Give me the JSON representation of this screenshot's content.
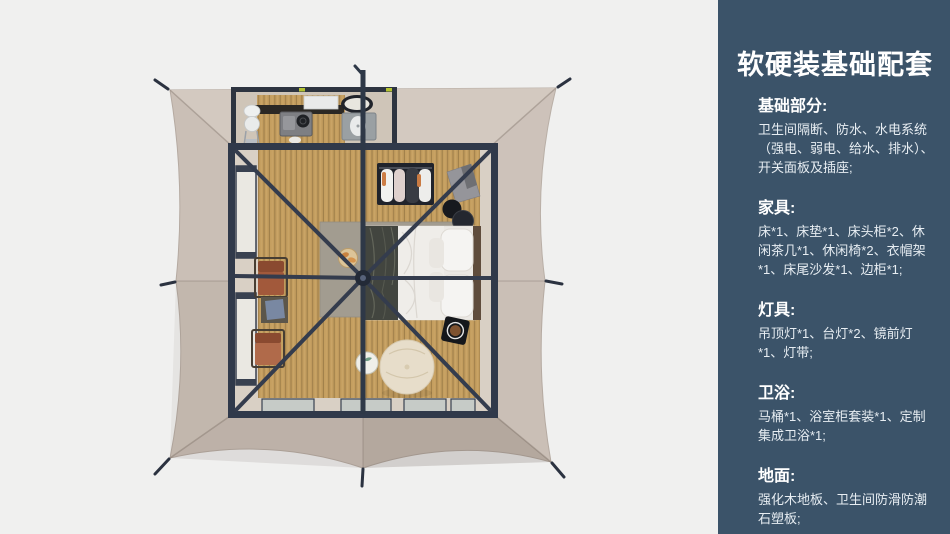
{
  "page": {
    "background": "#f0f0ef"
  },
  "panel": {
    "background": "#3b5369",
    "title": "软硬装基础配套",
    "sections": [
      {
        "heading": "基础部分:",
        "body": "卫生间隔断、防水、水电系统（强电、弱电、给水、排水）、开关面板及插座;"
      },
      {
        "heading": "家具:",
        "body": "床*1、床垫*1、床头柜*2、休闲茶几*1、休闲椅*2、衣帽架*1、床尾沙发*1、边柜*1;"
      },
      {
        "heading": "灯具:",
        "body": "吊顶灯*1、台灯*2、镜前灯*1、灯带;"
      },
      {
        "heading": "卫浴:",
        "body": "马桶*1、浴室柜套装*1、定制集成卫浴*1;"
      },
      {
        "heading": "地面:",
        "body": "强化木地板、卫生间防滑防潮石塑板;"
      }
    ]
  },
  "scene": {
    "description": "top-down 3D render of a square safari glamping tent with bedroom and bathroom",
    "colors": {
      "background": "#f0f0ef",
      "canvas": "#cabfb6",
      "canvas_flap": "#d3c9c0",
      "frame": "#333b4c",
      "wood_floor": "#c49e5f",
      "rug": "#a29c90",
      "chair": "#a2593b",
      "pouf": "#e7ddca",
      "bed_throw": "#42453f",
      "glass": "#c6cbc7"
    },
    "objects": [
      "tent-canopy",
      "guy-line-stakes",
      "tent-frame",
      "center-pole",
      "bathroom",
      "toilet",
      "washer",
      "shower",
      "mirror",
      "bed",
      "pillows",
      "throw-blanket",
      "wardrobe-rack",
      "hanging-clothes",
      "nightstand-stools",
      "tray-table",
      "lounge-chair",
      "tea-table",
      "pouf",
      "side-tray-table",
      "snack-stool",
      "rug",
      "side-windows",
      "glass-doors"
    ]
  }
}
